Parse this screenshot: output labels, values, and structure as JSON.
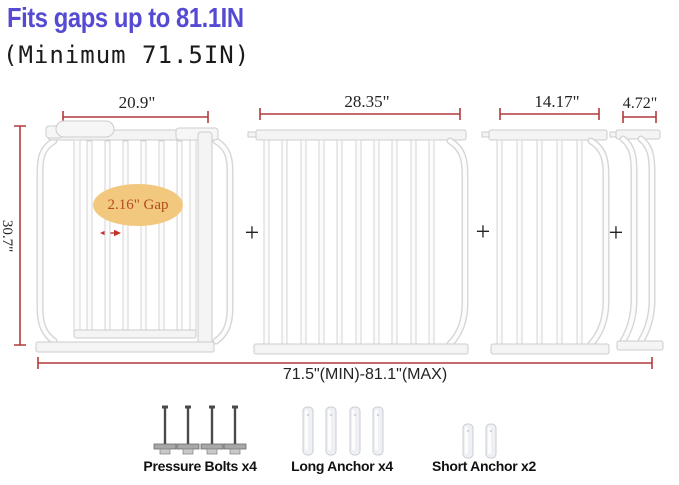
{
  "header": {
    "title": "Fits gaps up to 81.1IN",
    "subtitle": "(Minimum 71.5IN)"
  },
  "dimensions": {
    "gate_width": "20.9\"",
    "extension_large_width": "28.35\"",
    "extension_medium_width": "14.17\"",
    "extension_small_width": "4.72\"",
    "height": "30.7\"",
    "total_range": "71.5\"(MIN)-81.1\"(MAX)",
    "gap_label": "2.16\" Gap"
  },
  "plus_sign": "+",
  "accessories": [
    {
      "label": "Pressure Bolts x4",
      "count": 4
    },
    {
      "label": "Long Anchor x4",
      "count": 4
    },
    {
      "label": "Short Anchor x2",
      "count": 2
    }
  ],
  "colors": {
    "title": "#554bd2",
    "dimension_lines": "#b23a3a",
    "gap_ellipse_fill": "#f2c87f",
    "gap_text": "#b44a1e",
    "gap_arrow": "#c03326"
  }
}
